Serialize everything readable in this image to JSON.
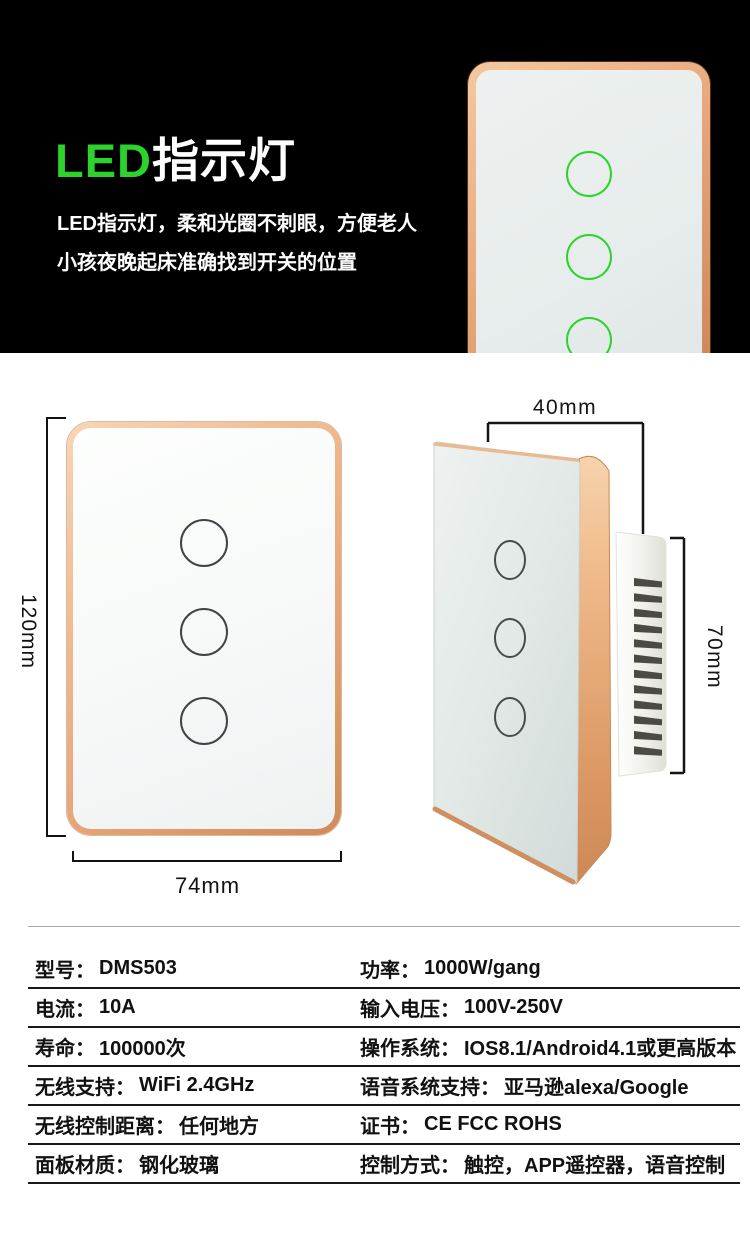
{
  "hero": {
    "title_led": "LED",
    "title_cn": "指示灯",
    "desc_line1": "LED指示灯，柔和光圈不刺眼，方便老人",
    "desc_line2": "小孩夜晚起床准确找到开关的位置"
  },
  "front_view": {
    "height_label": "120mm",
    "width_label": "74mm",
    "touch_buttons_count": "3"
  },
  "side_view": {
    "depth_label": "40mm",
    "body_height_label": "70mm"
  },
  "specs": {
    "rows": [
      {
        "left_label": "型号：",
        "left_value": "DMS503",
        "right_label": "功率：",
        "right_value": "1000W/gang"
      },
      {
        "left_label": "电流：",
        "left_value": "10A",
        "right_label": "输入电压：",
        "right_value": "100V-250V"
      },
      {
        "left_label": "寿命：",
        "left_value": "100000次",
        "right_label": "操作系统：",
        "right_value": "IOS8.1/Android4.1或更高版本"
      },
      {
        "left_label": "无线支持：",
        "left_value": "WiFi 2.4GHz",
        "right_label": "语音系统支持：",
        "right_value": "亚马逊alexa/Google"
      },
      {
        "left_label": "无线控制距离：",
        "left_value": "任何地方",
        "right_label": "证书：",
        "right_value": "CE FCC ROHS"
      },
      {
        "left_label": "面板材质：",
        "left_value": "钢化玻璃",
        "right_label": "控制方式：",
        "right_value": "触控，APP遥控器，语音控制"
      }
    ]
  },
  "colors": {
    "accent_green": "#2bd32b",
    "copper_frame": "#e8a87c",
    "hero_background": "#000000",
    "line_color": "#191919"
  }
}
